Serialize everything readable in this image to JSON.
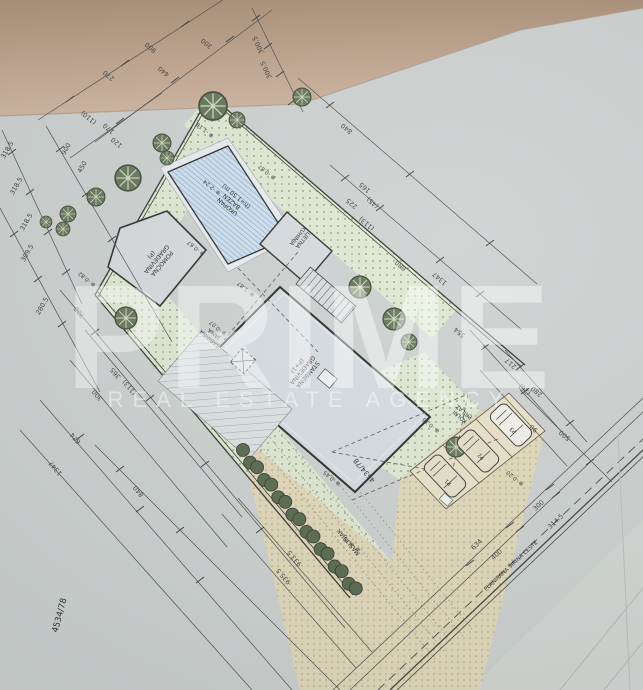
{
  "watermark": {
    "brand": "PRIME",
    "tagline": "REAL ESTATE AGENCY"
  },
  "parcel_number": "4534/78",
  "labels": [
    {
      "t": "POMOĆNA\nGRAĐEVINA\n(P)",
      "x": 155,
      "y": 258,
      "a": 130,
      "s": 6
    },
    {
      "t": "UKOPAN\nBAZEN\n(h=1.50 m)",
      "x": 233,
      "y": 200,
      "a": 220,
      "s": 6
    },
    {
      "t": "LJETNA\nKUHINJA",
      "x": 299,
      "y": 237,
      "a": 130,
      "s": 5.5
    },
    {
      "t": "SABIRNA\nJAMA",
      "x": 213,
      "y": 335,
      "a": 220,
      "s": 5.5
    },
    {
      "t": "STAMBENA\nGRAĐEVINA\n(P+1)",
      "x": 301,
      "y": 369,
      "a": 130,
      "s": 6
    },
    {
      "t": "KOLNI\nPRILAZ",
      "x": 463,
      "y": 413,
      "a": 220,
      "s": 5.5
    },
    {
      "t": "MASLINJAK",
      "x": 350,
      "y": 541,
      "a": 230,
      "s": 6
    },
    {
      "t": "4534/78",
      "x": 366,
      "y": 469,
      "a": 230,
      "s": 7
    },
    {
      "t": "4534/78",
      "x": 62,
      "y": 616,
      "a": 285,
      "s": 8.5
    },
    {
      "t": "PLANIRANA ŠIRINA CESTE",
      "x": 512,
      "y": 567,
      "a": 317,
      "s": 5.5
    },
    {
      "t": "P1",
      "x": 449,
      "y": 481,
      "a": 220,
      "s": 5.5
    },
    {
      "t": "P2",
      "x": 482,
      "y": 455,
      "a": 220,
      "s": 5.5
    },
    {
      "t": "P3",
      "x": 514,
      "y": 429,
      "a": 220,
      "s": 5.5
    }
  ],
  "dimensions": [
    {
      "t": "900",
      "x": 152,
      "y": 46,
      "a": 220
    },
    {
      "t": "270",
      "x": 110,
      "y": 74,
      "a": 220
    },
    {
      "t": "440",
      "x": 165,
      "y": 70,
      "a": 220
    },
    {
      "t": "300",
      "x": 208,
      "y": 42,
      "a": 220
    },
    {
      "t": "300.5",
      "x": 260,
      "y": 44,
      "a": 245
    },
    {
      "t": "300.5",
      "x": 268,
      "y": 69,
      "a": 245
    },
    {
      "t": "(110)",
      "x": 90,
      "y": 116,
      "a": 220
    },
    {
      "t": "170",
      "x": 110,
      "y": 127,
      "a": 220
    },
    {
      "t": "120",
      "x": 118,
      "y": 141,
      "a": 220
    },
    {
      "t": "318.5",
      "x": 9,
      "y": 151,
      "a": 300
    },
    {
      "t": "318.5",
      "x": 18,
      "y": 187,
      "a": 300
    },
    {
      "t": "318.5",
      "x": 28,
      "y": 223,
      "a": 300
    },
    {
      "t": "309.5",
      "x": 29,
      "y": 254,
      "a": 300
    },
    {
      "t": "280.5",
      "x": 44,
      "y": 307,
      "a": 300
    },
    {
      "t": "900",
      "x": 68,
      "y": 150,
      "a": 300
    },
    {
      "t": "450",
      "x": 84,
      "y": 168,
      "a": 300
    },
    {
      "t": "700",
      "x": 81,
      "y": 311,
      "a": 230
    },
    {
      "t": "365",
      "x": 117,
      "y": 372,
      "a": 230
    },
    {
      "t": "(113)",
      "x": 131,
      "y": 386,
      "a": 230
    },
    {
      "t": "300",
      "x": 99,
      "y": 394,
      "a": 230
    },
    {
      "t": "674",
      "x": 77,
      "y": 437,
      "a": 230
    },
    {
      "t": "1347",
      "x": 57,
      "y": 467,
      "a": 230
    },
    {
      "t": "840",
      "x": 140,
      "y": 490,
      "a": 230
    },
    {
      "t": "933.5",
      "x": 296,
      "y": 557,
      "a": 230
    },
    {
      "t": "935.5",
      "x": 285,
      "y": 575,
      "a": 230
    },
    {
      "t": "840",
      "x": 348,
      "y": 127,
      "a": 220
    },
    {
      "t": "165",
      "x": 366,
      "y": 186,
      "a": 220
    },
    {
      "t": "(45)",
      "x": 374,
      "y": 201,
      "a": 220
    },
    {
      "t": "225",
      "x": 353,
      "y": 202,
      "a": 220
    },
    {
      "t": "(113)",
      "x": 368,
      "y": 222,
      "a": 220
    },
    {
      "t": "680",
      "x": 402,
      "y": 264,
      "a": 220
    },
    {
      "t": "1347",
      "x": 441,
      "y": 277,
      "a": 220
    },
    {
      "t": "554",
      "x": 461,
      "y": 331,
      "a": 220
    },
    {
      "t": "217",
      "x": 512,
      "y": 362,
      "a": 220
    },
    {
      "t": "(26)",
      "x": 526,
      "y": 388,
      "a": 220
    },
    {
      "t": "90",
      "x": 535,
      "y": 427,
      "a": 220
    },
    {
      "t": "280",
      "x": 538,
      "y": 390,
      "a": 220
    },
    {
      "t": "500",
      "x": 566,
      "y": 434,
      "a": 220
    },
    {
      "t": "300",
      "x": 540,
      "y": 507,
      "a": 317
    },
    {
      "t": "314.5",
      "x": 557,
      "y": 523,
      "a": 317
    },
    {
      "t": "634",
      "x": 478,
      "y": 546,
      "a": 317
    },
    {
      "t": "400",
      "x": 498,
      "y": 556,
      "a": 317
    }
  ],
  "elevations": [
    {
      "t": "⊕ -1.18",
      "x": 206,
      "y": 129,
      "a": 220
    },
    {
      "t": "⊕ -0.67",
      "x": 268,
      "y": 171,
      "a": 220
    },
    {
      "t": "⊕ -0.67",
      "x": 197,
      "y": 247,
      "a": 220
    },
    {
      "t": "⊕ -0.82",
      "x": 88,
      "y": 278,
      "a": 220
    },
    {
      "t": "⊕ -2.24",
      "x": 213,
      "y": 186,
      "a": 220
    },
    {
      "t": "⊕ -1.87",
      "x": 247,
      "y": 288,
      "a": 220
    },
    {
      "t": "⊕ -0.07",
      "x": 219,
      "y": 327,
      "a": 220
    },
    {
      "t": "⊕ -0.45",
      "x": 333,
      "y": 477,
      "a": 220
    },
    {
      "t": "⊕ -0.75",
      "x": 353,
      "y": 543,
      "a": 220
    },
    {
      "t": "⊕ -0.15",
      "x": 432,
      "y": 424,
      "a": 220
    },
    {
      "t": "⊕ -0.20",
      "x": 516,
      "y": 477,
      "a": 220
    }
  ]
}
